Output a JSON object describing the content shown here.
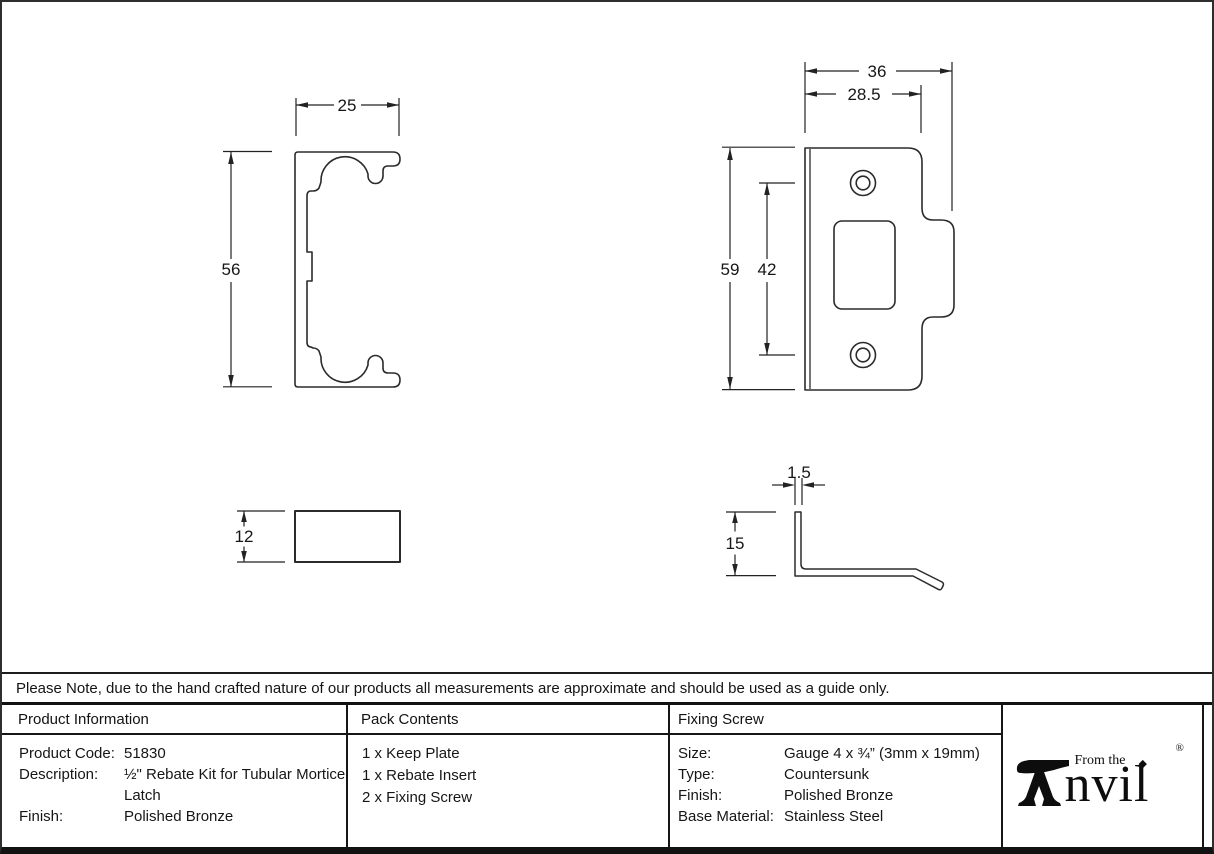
{
  "note": {
    "text": "Please Note, due to the hand crafted nature of our products all measurements are approximate and should be used as a guide only."
  },
  "drawings": {
    "rebate_front": {
      "width": "25",
      "height": "56"
    },
    "keep_front": {
      "overall_width": "36",
      "plate_width": "28.5",
      "overall_height": "59",
      "hole_spacing": "42"
    },
    "rebate_side": {
      "height": "12"
    },
    "keep_side": {
      "thickness": "1.5",
      "leg_height": "15"
    }
  },
  "table": {
    "product_information": {
      "title": "Product Information",
      "rows": [
        {
          "label": "Product Code:",
          "value": "51830"
        },
        {
          "label": "Description:",
          "value": "½\" Rebate Kit for Tubular Mortice Latch"
        },
        {
          "label": "Finish:",
          "value": "Polished Bronze"
        }
      ]
    },
    "pack_contents": {
      "title": "Pack Contents",
      "items": [
        "1 x Keep Plate",
        "1 x Rebate Insert",
        "2 x Fixing Screw"
      ]
    },
    "fixing_screw": {
      "title": "Fixing Screw",
      "rows": [
        {
          "label": "Size:",
          "value": "Gauge 4 x ¾” (3mm x 19mm)"
        },
        {
          "label": "Type:",
          "value": "Countersunk"
        },
        {
          "label": "Finish:",
          "value": "Polished Bronze"
        },
        {
          "label": "Base Material:",
          "value": "Stainless Steel"
        }
      ]
    }
  },
  "logo": {
    "brand": "Anvil",
    "from_the": "From the",
    "wordmark_rest": "nvil",
    "diamond": "◆",
    "registered": "®"
  },
  "colors": {
    "line": "#2b2b2b",
    "border": "#111111"
  }
}
